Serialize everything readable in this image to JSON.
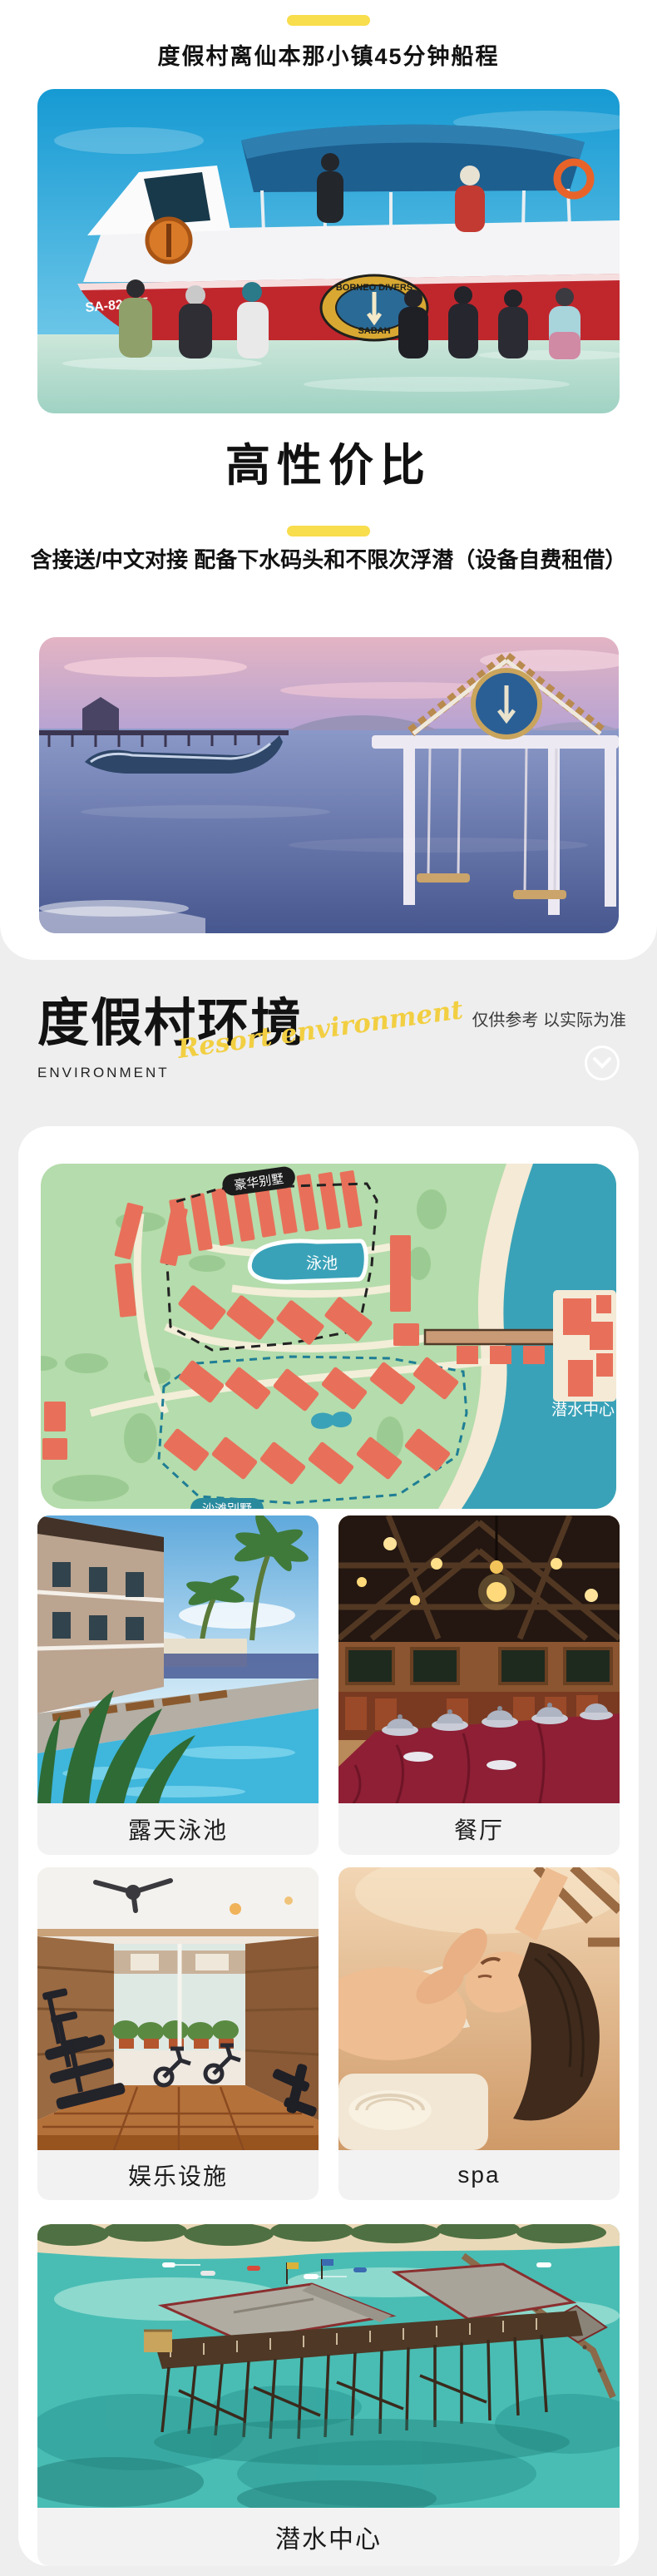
{
  "colors": {
    "accent_yellow": "#f8dd4d",
    "page_bg": "#eeeeef"
  },
  "top": {
    "headline1": "度假村离仙本那小镇45分钟船程",
    "headline2": "高性价比",
    "headline3": "含接送/中文对接 配备下水码头和不限次浮潜（设备自费租借）",
    "boat_photo": {
      "logo_top": "BORNEO DIVERS",
      "logo_bottom": "SABAH",
      "registration": "SA-8296/5"
    }
  },
  "env": {
    "title": "度假村环境",
    "subtitle_en": "ENVIRONMENT",
    "script_text": "Resort environment",
    "disclaimer": "仅供参考 以实际为准",
    "map_labels": {
      "luxury_villa": "豪华别墅",
      "pool": "泳池",
      "dive_center": "潜水中心",
      "beach_villa": "沙滩别墅"
    },
    "gallery": [
      {
        "caption": "露天泳池"
      },
      {
        "caption": "餐厅"
      },
      {
        "caption": "娱乐设施"
      },
      {
        "caption": "spa"
      },
      {
        "caption": "潜水中心"
      }
    ]
  }
}
